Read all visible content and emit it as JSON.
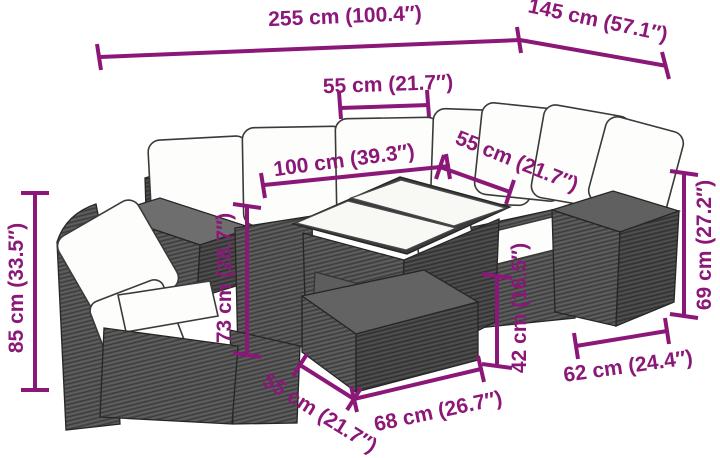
{
  "diagram": {
    "description": "Line drawing of a poly rattan garden lounge set (corner sofa, glass-top table, ottoman, side tables) with dimension arrows",
    "accent_color": "#8b1878",
    "rattan_color": "#4f4f4f",
    "cushion_color": "#ffffff",
    "background_color": "#ffffff"
  },
  "dimensions": {
    "overall_width": {
      "label": "255 cm (100.4″)"
    },
    "overall_depth": {
      "label": "145 cm (57.1″)"
    },
    "back_section_width": {
      "label": "55 cm (21.7″)"
    },
    "table_length": {
      "label": "100 cm (39.3″)"
    },
    "right_section_width": {
      "label": "55 cm (21.7″)"
    },
    "backrest_height": {
      "label": "85 cm (33.5″)"
    },
    "table_height": {
      "label": "73 cm (28.7″)"
    },
    "ottoman_height": {
      "label": "42 cm (16.5″)"
    },
    "side_table_height": {
      "label": "69 cm (27.2″)"
    },
    "side_table_width": {
      "label": "62 cm (24.4″)"
    },
    "ottoman_depth": {
      "label": "55 cm (21.7″)"
    },
    "ottoman_width": {
      "label": "68 cm (26.7″)"
    }
  }
}
